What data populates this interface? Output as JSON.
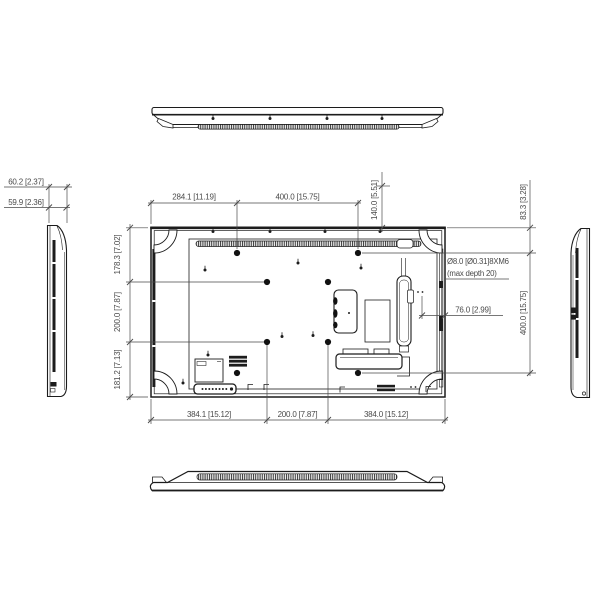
{
  "drawing": {
    "kind": "display mechanical outline drawing, rear + top + bottom + side views",
    "units": "mm [inch]",
    "colors": {
      "background": "#ffffff",
      "line": "#1c1c1c",
      "dim": "#4a4a4a"
    }
  },
  "dims": {
    "side_depth_outer": "60.2 [2.37]",
    "side_depth_inner": "59.9 [2.36]",
    "top_left_to_vesa": "284.1 [11.19]",
    "top_vesa_width": "400.0 [15.75]",
    "top_to_hole_140": "140.0 [5.51]",
    "top_to_vesa_row": "83.3 [3.28]",
    "left_top": "178.3 [7.02]",
    "left_mid": "200.0 [7.87]",
    "left_bottom": "181.2 [7.13]",
    "vesa_note_1": "Ø8.0 [Ø0.31]8XM6",
    "vesa_note_2": "(max depth 20)",
    "edge_offset_76": "76.0 [2.99]",
    "right_vesa_height": "400.0 [15.75]",
    "bottom_left": "384.1 [15.12]",
    "bottom_mid": "200.0 [7.87]",
    "bottom_right": "384.0 [15.12]"
  }
}
